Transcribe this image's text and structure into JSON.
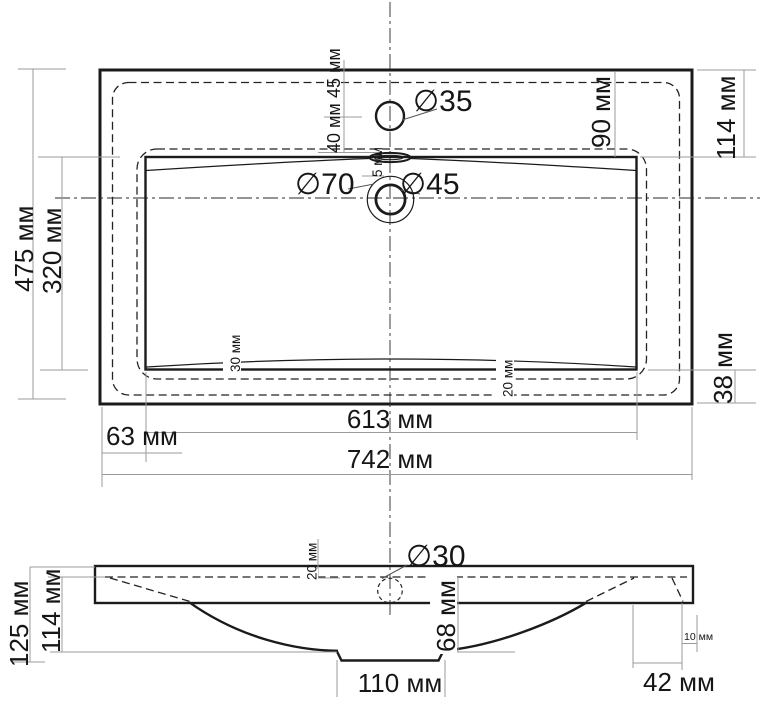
{
  "colors": {
    "line": "#1b1b1b",
    "dim_line": "#9b9b9b",
    "background": "#ffffff"
  },
  "top_view": {
    "dia_faucet_hole": "∅35",
    "dia_drain_outer": "∅70",
    "dia_drain_inner": "∅45",
    "dim_faucet_offset": "45 мм",
    "dim_faucet_to_basin": "40 мм",
    "dim_overflow_slot": "5 мм",
    "dim_edge_to_basin_right": "90 мм",
    "dim_right_margin": "114 мм",
    "dim_overall_depth": "475 мм",
    "dim_basin_depth": "320 мм",
    "dim_slope_left": "30 мм",
    "dim_slope_right": "20 мм",
    "dim_bottom_margin": "38 мм",
    "dim_left_margin": "63 мм",
    "dim_basin_width": "613 мм",
    "dim_overall_width": "742 мм"
  },
  "side_view": {
    "dia_overflow_hole": "∅30",
    "dim_overall_height": "125 мм",
    "dim_inner_height": "114 мм",
    "dim_rim_thickness": "20 мм",
    "dim_basin_depth": "68 мм",
    "dim_drain_boss_width": "110 мм",
    "dim_right_inset": "42 мм",
    "dim_wall_offset": "10 мм"
  }
}
